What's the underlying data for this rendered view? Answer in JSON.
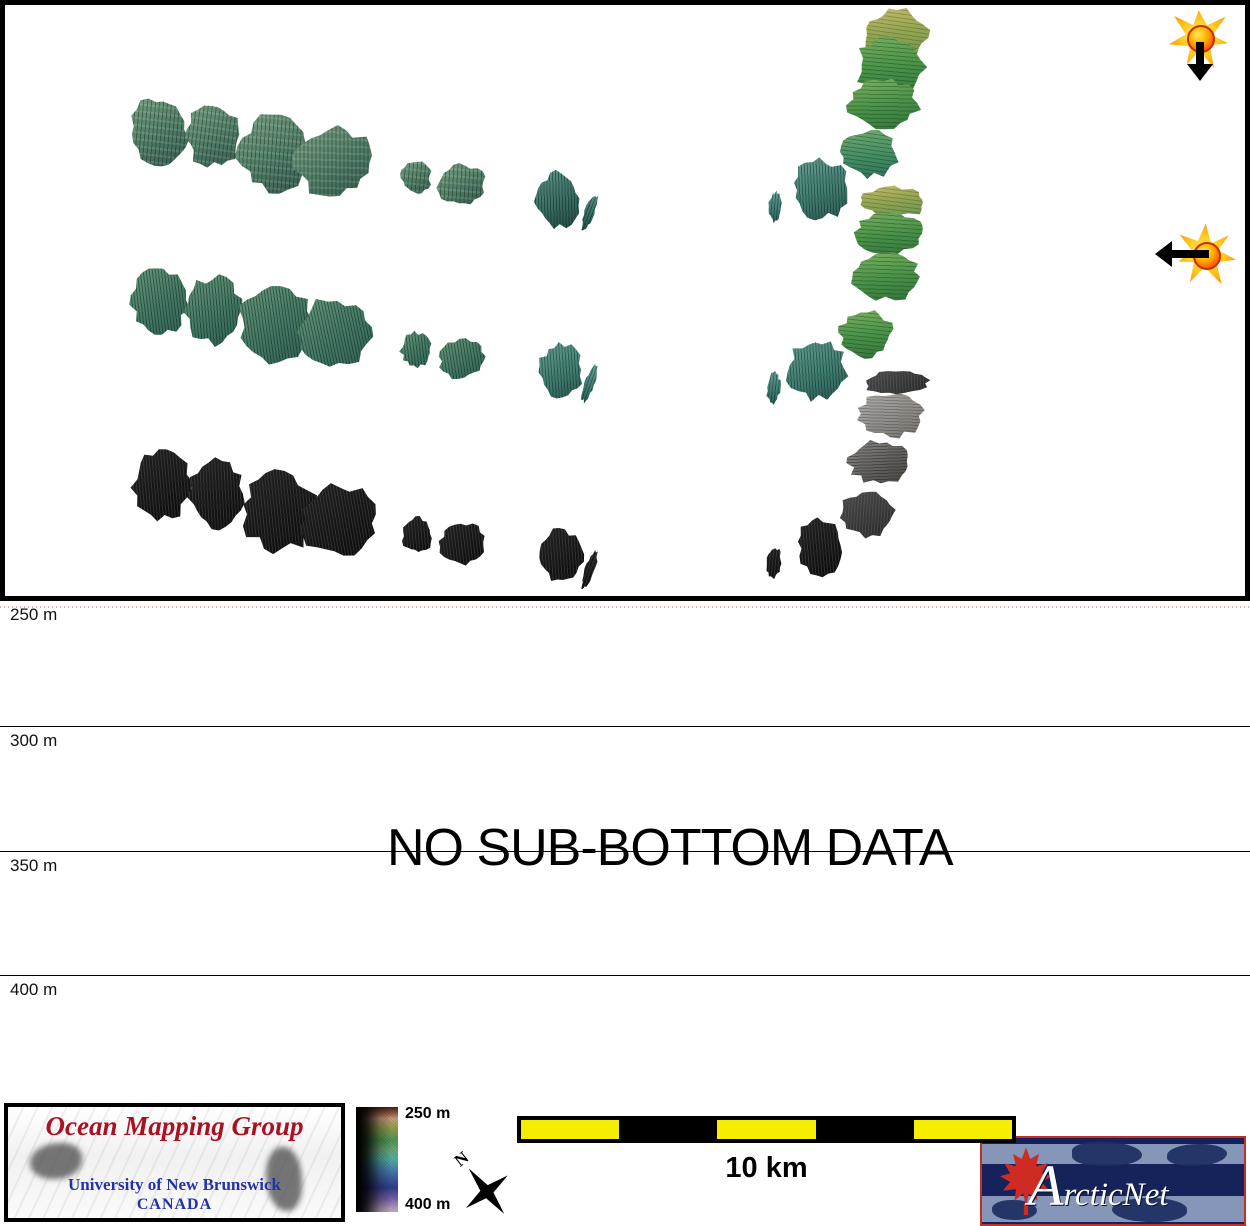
{
  "profile_panel": {
    "depth_ticks": [
      "250 m",
      "300 m",
      "350 m",
      "400 m"
    ],
    "no_data_label": "NO SUB-BOTTOM DATA"
  },
  "footer": {
    "omg": {
      "title": "Ocean Mapping Group",
      "institution": "University of New Brunswick",
      "country": "CANADA"
    },
    "legend": {
      "top": "250 m",
      "bottom": "400 m"
    },
    "compass": {
      "north": "N"
    },
    "scalebar": {
      "label": "10 km"
    },
    "arcticnet": {
      "initial": "A",
      "rest": "rcticNet"
    }
  },
  "icons": {
    "flare_down": "starburst-with-down-arrow",
    "flare_left": "starburst-with-left-arrow",
    "north_arrow": "four-point-compass-star",
    "maple_leaf": "red-maple-leaf"
  },
  "colors": {
    "scalebar_yellow": "#F6EE00",
    "omg_title_red": "#AA1122",
    "omg_text_blue": "#2233AA",
    "arcticnet_navy": "#16235A",
    "leaf_red": "#CE2B24",
    "swath_green": "#4D7A63",
    "swath_teal": "#37695F",
    "swath_black": "#111111",
    "swath_gray": "#8D8A85"
  }
}
